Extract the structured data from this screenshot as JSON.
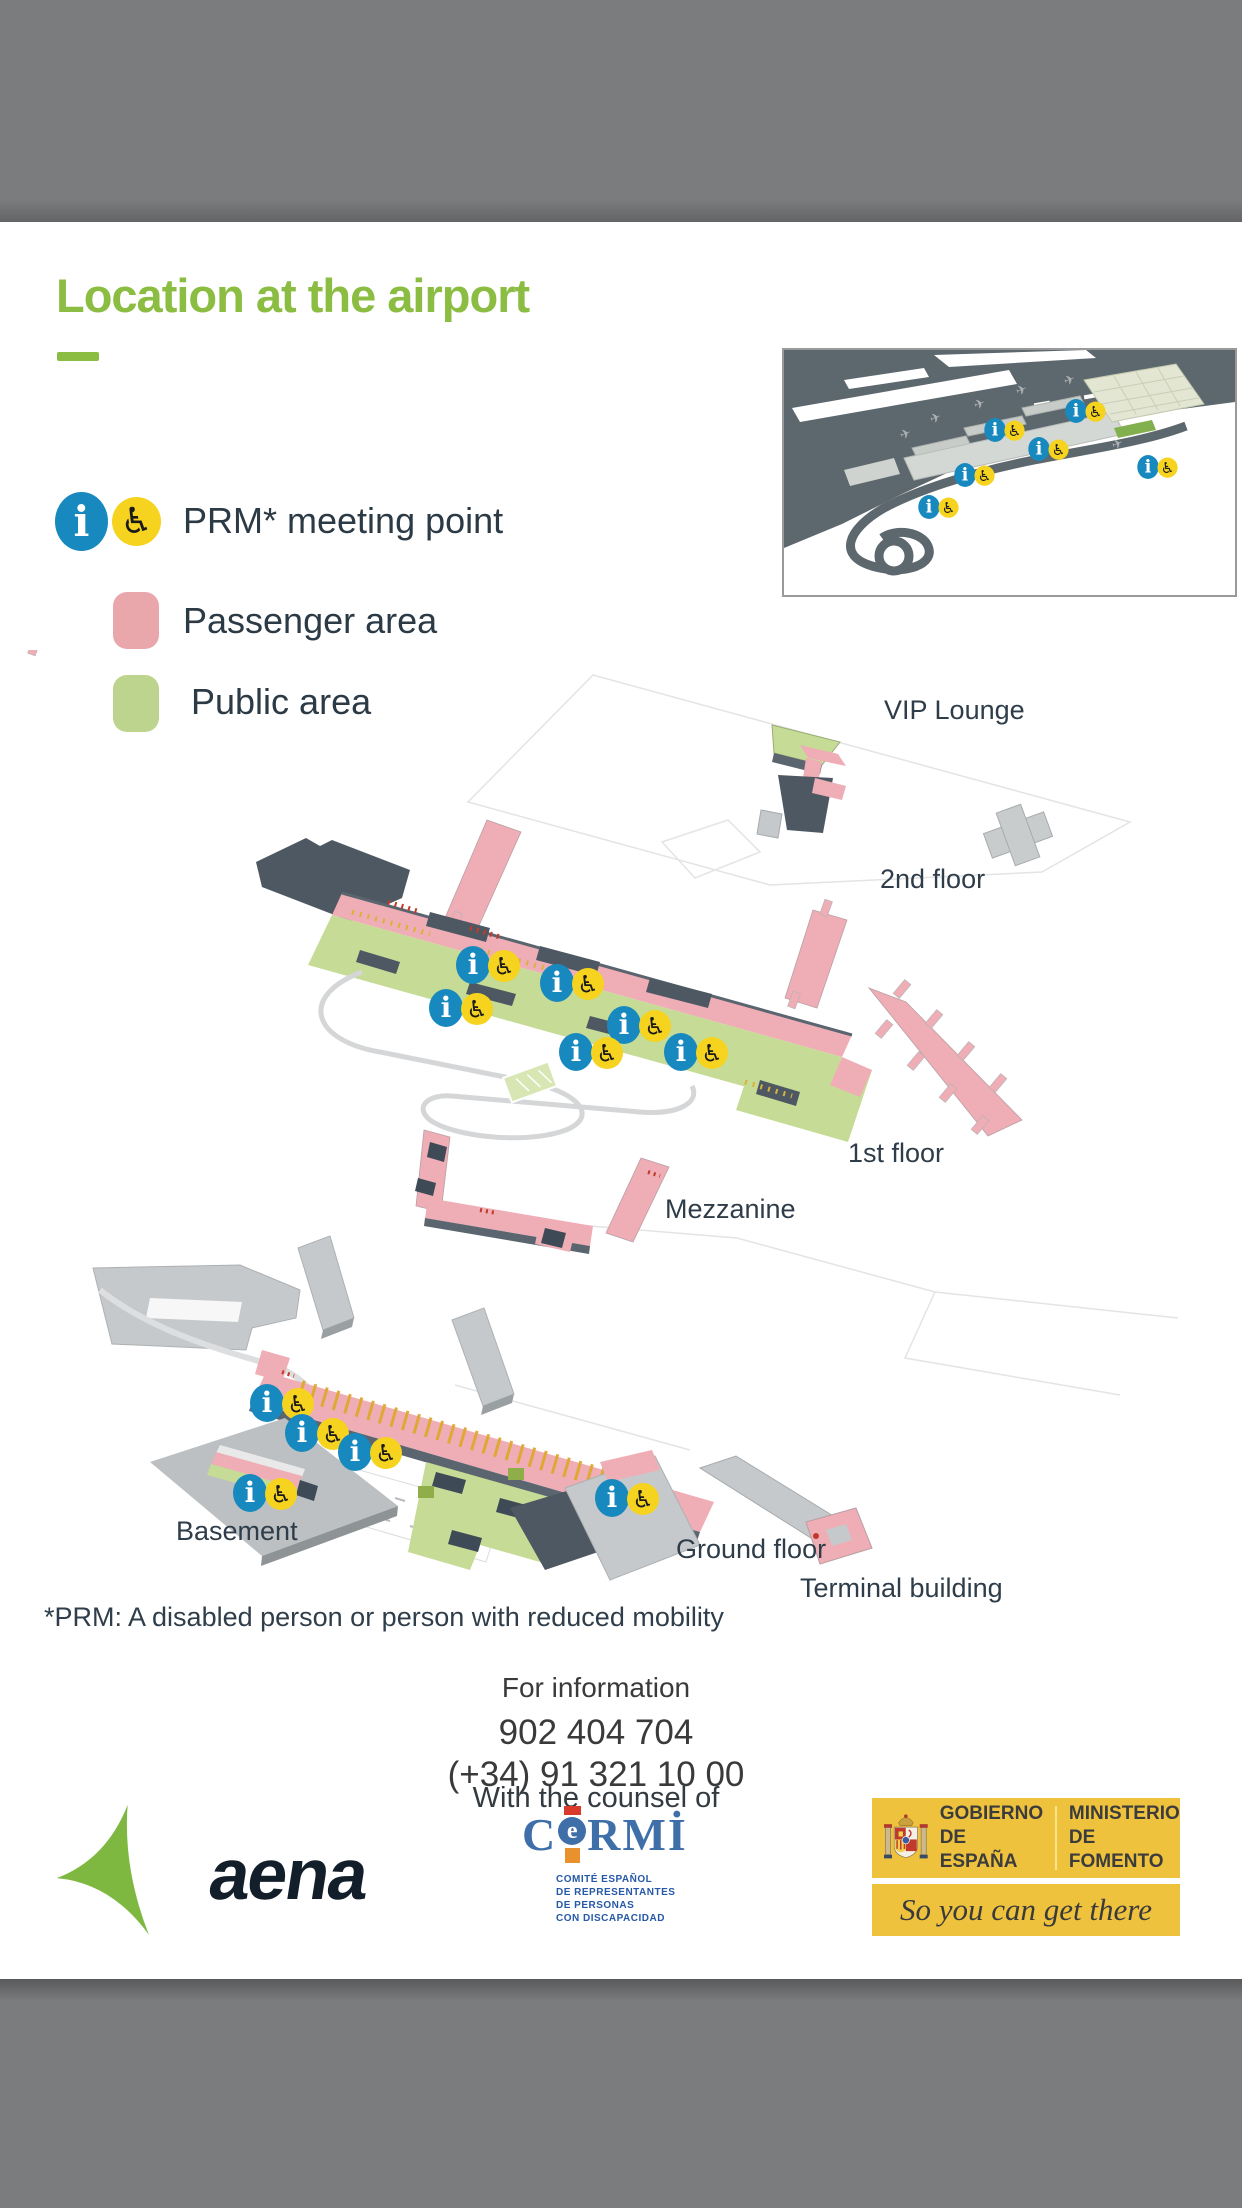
{
  "title": {
    "text": "Location at the airport",
    "accent_color": "#8bbd42"
  },
  "icons": {
    "info": "i",
    "wheelchair": "♿"
  },
  "legend": {
    "prm_label": "PRM* meeting point",
    "passenger_label": "Passenger area",
    "public_label": "Public area"
  },
  "map": {
    "labels": {
      "vip_lounge": "VIP Lounge",
      "second_floor": "2nd floor",
      "first_floor": "1st floor",
      "mezzanine": "Mezzanine",
      "basement": "Basement",
      "ground_floor": "Ground floor",
      "terminal_building": "Terminal building"
    },
    "colors": {
      "passenger_area": "#efadb5",
      "public_area": "#c6dc96",
      "marker_blue": "#1789be",
      "marker_yellow": "#f6d31e",
      "roof_dark": "#4d5863",
      "building_light": "#c6c9cb"
    }
  },
  "footnote": {
    "text": "*PRM: A disabled person or person with reduced mobility"
  },
  "contact": {
    "heading": "For information",
    "phone1": "902 404 704",
    "phone2": "(+34) 91 321 10 00"
  },
  "counsel": {
    "heading": "With the counsel of",
    "cermi_part_c": "C",
    "cermi_part_e": "e",
    "cermi_part_rmi": "RMİ",
    "caption_line1": "COMITÉ ESPAÑOL",
    "caption_line2": "DE REPRESENTANTES",
    "caption_line3": "DE PERSONAS",
    "caption_line4": "CON DISCAPACIDAD"
  },
  "brand": {
    "aena_text": "aena"
  },
  "government": {
    "gobierno_line1": "GOBIERNO",
    "gobierno_line2": "DE ESPAÑA",
    "ministerio_line1": "MINISTERIO",
    "ministerio_line2": "DE FOMENTO",
    "tagline": "So you can get there"
  }
}
